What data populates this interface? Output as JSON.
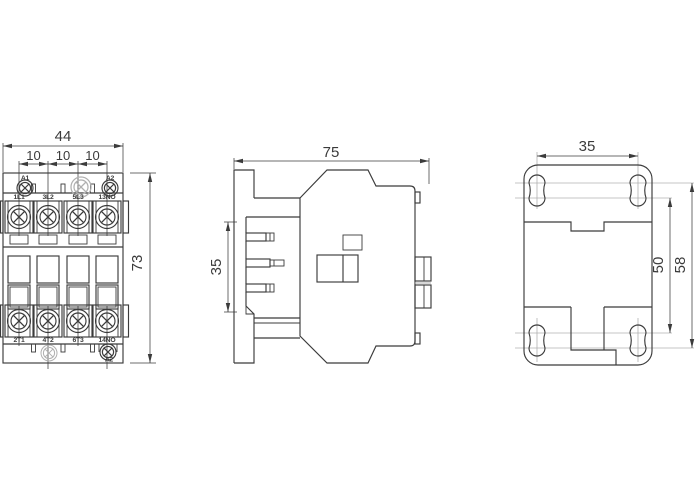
{
  "title": "Contactor dimensional drawing - three views",
  "front": {
    "dims": {
      "width": "44",
      "pitch": [
        "10",
        "10",
        "10"
      ],
      "height": "73"
    },
    "labels": {
      "coil_top_left": "A1",
      "coil_top_right": "A2",
      "coil_bottom": "A2",
      "row_top": [
        "1L1",
        "3L2",
        "5L3",
        "13NO"
      ],
      "row_bottom": [
        "2T1",
        "4T2",
        "6T3",
        "14NO"
      ]
    }
  },
  "side": {
    "dims": {
      "depth": "75",
      "rail_height": "35"
    }
  },
  "rear": {
    "dims": {
      "hole_pitch_x": "35",
      "hole_pitch_y_inner": "50",
      "hole_pitch_y_outer": "58"
    }
  },
  "colors": {
    "line": "#3b3b3b",
    "light": "#b0b0b0",
    "background": "#ffffff"
  }
}
